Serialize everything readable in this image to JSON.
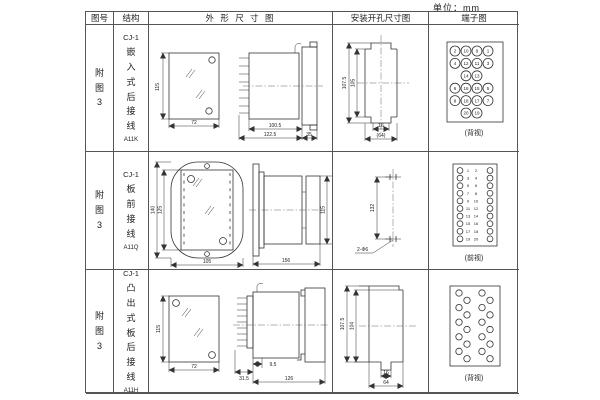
{
  "unit_label": "单位：mm",
  "header": {
    "col_fig": "图号",
    "col_struct": "结构",
    "col_outline": "外 形 尺 寸 图",
    "col_install": "安装开孔尺寸图",
    "col_terminal": "端子图"
  },
  "rows": [
    {
      "fig_no": "附图3",
      "model": "CJ-1",
      "desc": "嵌入式后接线",
      "code": "A11K",
      "outline": {
        "front_h": "115",
        "front_w": "72",
        "side_body": "100.5",
        "side_total": "122.5",
        "side_flange": "35"
      },
      "install": {
        "v_outer": "107.5",
        "v_inner": "105",
        "h_small": "16",
        "h_big": "(64)"
      },
      "terminal": {
        "caption": "(背视)",
        "type": "grid4",
        "grid": [
          [
            2,
            10,
            9,
            1
          ],
          [
            4,
            12,
            11,
            3
          ],
          [
            null,
            14,
            13,
            null
          ],
          [
            6,
            16,
            15,
            5
          ],
          [
            8,
            18,
            17,
            7
          ],
          [
            null,
            20,
            19,
            null
          ]
        ]
      }
    },
    {
      "fig_no": "附图3",
      "model": "CJ-1",
      "desc": "板前接线",
      "code": "A11Q",
      "outline": {
        "front_h_outer": "140",
        "front_h_inner": "125",
        "front_w": "105",
        "side_w": "156",
        "side_h": "115"
      },
      "install": {
        "v_span": "132",
        "hole_label": "2-Φ6"
      },
      "terminal": {
        "caption": "(前视)",
        "type": "cols2",
        "left": [
          1,
          3,
          5,
          7,
          9,
          11,
          13,
          15,
          17,
          19
        ],
        "right": [
          2,
          4,
          6,
          8,
          10,
          12,
          14,
          16,
          18,
          20
        ]
      }
    },
    {
      "fig_no": "附图3",
      "model": "CJ-1",
      "desc": "凸出式板后接线",
      "code": "A11H",
      "outline": {
        "front_h": "115",
        "front_w": "72",
        "side_pins": "31.5",
        "side_offset": "9.5",
        "side_total": "126"
      },
      "install": {
        "v_outer": "107.5",
        "v_inner": "104",
        "h_small": "16",
        "h_big": "64"
      },
      "terminal": {
        "caption": "(背视)",
        "type": "zigzag",
        "count": 20
      }
    }
  ]
}
